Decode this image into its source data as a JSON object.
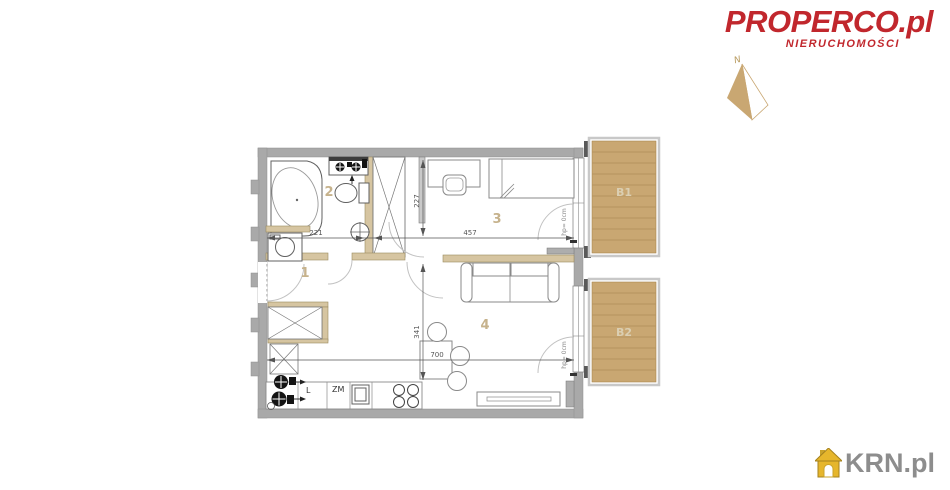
{
  "branding": {
    "logo_text": "PROPERCO.pl",
    "logo_subtext": "NIERUCHOMOŚCI",
    "logo_color": "#c1272d"
  },
  "compass": {
    "north_label": "N"
  },
  "watermark": {
    "text": "KRN.pl",
    "icon": "house-icon",
    "icon_color": "#e6b62c",
    "text_color": "#8d8d8d"
  },
  "floorplan": {
    "rooms": [
      {
        "label": "1"
      },
      {
        "label": "2"
      },
      {
        "label": "3"
      },
      {
        "label": "4"
      }
    ],
    "balconies": [
      {
        "label": "B1"
      },
      {
        "label": "B2"
      }
    ],
    "dimensions": {
      "hall_width": "221",
      "bedroom_width": "457",
      "bedroom_depth": "227",
      "living_depth": "341",
      "total_width": "700"
    },
    "door_notes": {
      "bedroom_balcony": "hp= 0cm",
      "living_balcony": "hp= 0cm"
    },
    "kitchen": {
      "fridge_label": "L",
      "dishwasher_label": "ZM"
    },
    "colors": {
      "wall": "#a9a9a9",
      "wood_accent": "#d6c5a1",
      "deck": "#c9a772",
      "room_number": "#c6b28c"
    }
  }
}
